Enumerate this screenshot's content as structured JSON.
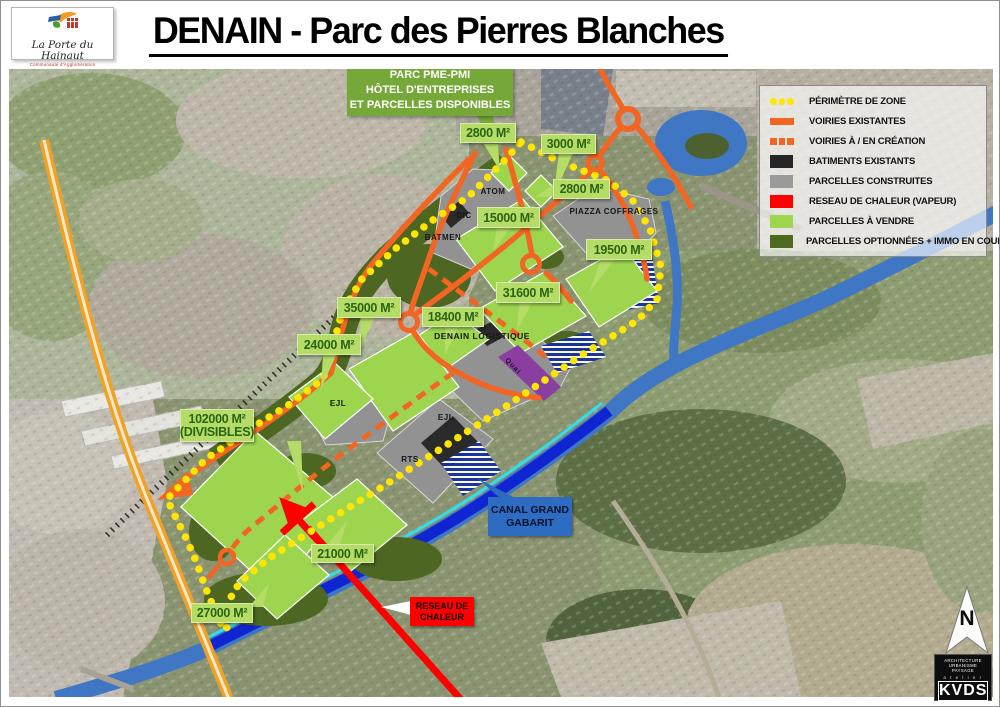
{
  "header": {
    "title": "DENAIN - Parc des Pierres Blanches"
  },
  "logo": {
    "name": "La Porte du Hainaut",
    "subtitle": "Communauté d'Agglomération"
  },
  "park_box": {
    "line1": "PARC PME-PMI",
    "line2": "HÔTEL D'ENTREPRISES",
    "line3": "ET PARCELLES DISPONIBLES"
  },
  "legend": {
    "items": [
      {
        "label": "PÉRIMÈTRE DE ZONE",
        "swatch": "yellow-dots",
        "color": "#ffe600"
      },
      {
        "label": "VOIRIES EXISTANTES",
        "swatch": "orange-bar",
        "color": "#f26522"
      },
      {
        "label": "VOIRIES À / EN CRÉATION",
        "swatch": "orange-dashed",
        "color": "#f26522"
      },
      {
        "label": "BATIMENTS EXISTANTS",
        "swatch": "box",
        "color": "#262626"
      },
      {
        "label": "PARCELLES CONSTRUITES",
        "swatch": "box",
        "color": "#9a9a9a"
      },
      {
        "label": "RESEAU DE CHALEUR (VAPEUR)",
        "swatch": "box",
        "color": "#fe0000"
      },
      {
        "label": "PARCELLES À VENDRE",
        "swatch": "box",
        "color": "#9ed54f"
      },
      {
        "label": "PARCELLES OPTIONNÉES + IMMO EN COURS",
        "swatch": "box",
        "color": "#4c6b1f"
      }
    ]
  },
  "areas": [
    {
      "text": "2800 M²"
    },
    {
      "text": "3000 M²"
    },
    {
      "text": "2800 M²"
    },
    {
      "text": "15000 M²"
    },
    {
      "text": "19500 M²"
    },
    {
      "text": "31600 M²"
    },
    {
      "text": "35000 M²"
    },
    {
      "text": "18400 M²"
    },
    {
      "text": "24000 M²"
    },
    {
      "text": "102000 M²",
      "text2": "(DIVISIBLES)"
    },
    {
      "text": "21000 M²"
    },
    {
      "text": "27000 M²"
    }
  ],
  "parcels": [
    {
      "name": "ATOM"
    },
    {
      "name": "DIC"
    },
    {
      "name": "BATMEN"
    },
    {
      "name": "PIAZZA COFFRAGES"
    },
    {
      "name": "DENAIN LOGISTIQUE"
    },
    {
      "name": "EJL"
    },
    {
      "name": "EJL"
    },
    {
      "name": "RTS"
    },
    {
      "name": "Quai"
    }
  ],
  "callouts": {
    "canal": "CANAL GRAND GABARIT",
    "reseau_line1": "RESEAU DE",
    "reseau_line2": "CHALEUR"
  },
  "north": {
    "label": "N"
  },
  "kvds": {
    "line1": "ARCHITECTURE",
    "line2": "URBANISME",
    "line3": "PAYSAGE",
    "atelier": "a t e l i e r",
    "name": "KVDS"
  },
  "colors": {
    "roads_orange": "#f26522",
    "motorway_orange": "#f1a226",
    "perimeter_yellow": "#ffe600",
    "parcel_green": "#9ed54f",
    "optioned_dark_green": "#4c6b1f",
    "built_gray": "#9a9a9a",
    "buildings_dark": "#262626",
    "heat_red": "#fe0000",
    "canal_blue": "#3f77c4",
    "canal_highlight": "#0c1ed2",
    "canal_cyan": "#2ee0ee",
    "quai_purple": "#8a3fa0",
    "label_green_bg": "#b4dc66",
    "park_header_green": "#76a839",
    "canal_label_blue": "#2d6cc0"
  }
}
